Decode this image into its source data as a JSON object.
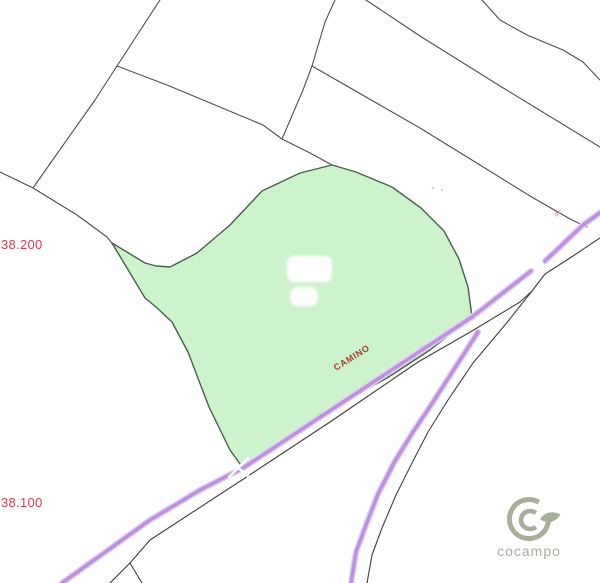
{
  "labels": {
    "grid_north_upper": "38.200",
    "grid_north_lower": "38.100",
    "camino": "CAMINO",
    "road_code": "dc",
    "logo_text": "cocampo"
  },
  "colors": {
    "background": "#ffffff",
    "parcel_fill": "#cdf3cc",
    "parcel_stroke": "#47604a",
    "boundary_line": "#4f4f4f",
    "road_purple": "#bd91e1",
    "road_halo": "#e3d2f3",
    "grid_label": "#d14055",
    "camino_label": "#a6392c",
    "road_code_label": "#cf7d9b",
    "logo": "#a5af9a",
    "building_fill": "#ffffff",
    "faint_mark": "#cfcfcf"
  },
  "geometry": {
    "parcel": {
      "d": "M112 243 L145 263 L156 266 L170 267 L197 253 L230 225 L262 191 L300 173 L332 165 L356 172 L392 187 L421 208 L444 231 L459 259 L468 287 L472 317 L430 350 L387 378 L320 414 L277 447 L243 468 L230 450 L209 407 L188 352 L172 322 L156 307 L145 298 Z"
    },
    "boundaries": [
      {
        "name": "boundary-north-1",
        "d": "M160 0 L117 66"
      },
      {
        "name": "boundary-northwest",
        "d": "M117 66 L95 100 L35 185 L33 188"
      },
      {
        "name": "boundary-west",
        "d": "M0 172 L33 188 L77 215 L107 237 L115 247"
      },
      {
        "name": "boundary-to-parcel-peak",
        "d": "M117 66 L167 85 L227 110 L263 125 L282 139 L310 153 L332 165"
      },
      {
        "name": "boundary-north-2",
        "d": "M335 0 L325 22 L312 66 L303 90 L282 139"
      },
      {
        "name": "boundary-northeast-long",
        "d": "M312 66 L420 128 L480 165 L530 196 L570 219 L587 227"
      },
      {
        "name": "boundary-topright-1",
        "d": "M366 0 L420 36 L500 86 L600 147"
      },
      {
        "name": "boundary-topright-2",
        "d": "M482 0 L500 20 L527 35 L563 50 L583 62 L600 80"
      }
    ],
    "casings": [
      {
        "name": "track-casing-south",
        "d": "M600 238 L570 258 L545 274 L532 291 L520 302 L472 331 L418 362 L330 422 L245 478 L150 540 L130 563 L110 583"
      },
      {
        "name": "track-casing-fork",
        "d": "M130 563 L142 583"
      },
      {
        "name": "branch-casing-east",
        "d": "M532 291 L505 325 L473 363 L448 400 L428 432 L412 463 L396 495 L382 528 L372 555 L367 583"
      }
    ],
    "roads": {
      "main": {
        "d": "M601 212 L583 225 L545 261 M531 271 L472 317 L243 468 L200 490 L150 520 L62 583"
      },
      "branch": {
        "d": "M478 332 L460 360 L433 402 L413 432 L395 461 L378 494 L366 525 L356 552 L351 583"
      }
    },
    "junction_cross": {
      "d": "M228 459 L249 477 M229 477 L248 458"
    },
    "buildings": [
      {
        "x": 287,
        "y": 256,
        "w": 45,
        "h": 26,
        "rx": 7
      },
      {
        "x": 290,
        "y": 287,
        "w": 28,
        "h": 19,
        "rx": 8
      }
    ],
    "faint_marks": [
      {
        "cx": 433,
        "cy": 188,
        "r": 1.5
      },
      {
        "cx": 442,
        "cy": 190,
        "r": 1.2
      }
    ],
    "logo": {
      "outer_ring": "M547.8 514 A19.5 19.5 0 1 1 538.8 502.2",
      "inner_ring": "M535.8 526.9 A9 9 0 1 1 535.8 513.1",
      "leaf": "M540 519 C545 511.5 553 510.5 560.5 514.5 C555.5 523 546 524.5 540 519 Z"
    }
  }
}
